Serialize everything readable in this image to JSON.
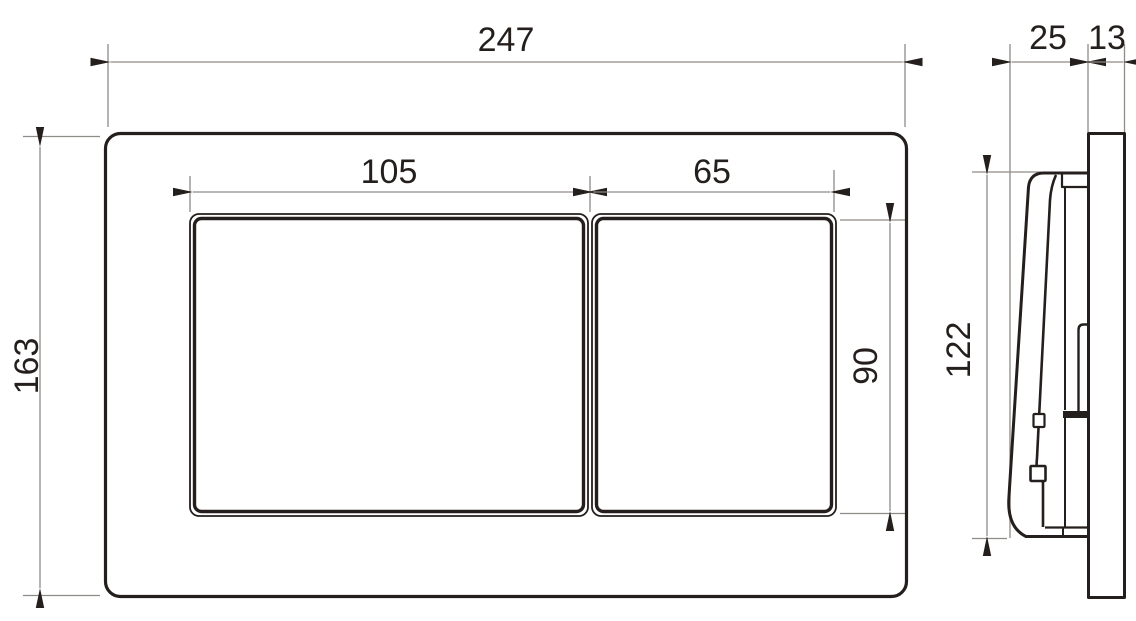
{
  "drawing": {
    "subject": "Two-button flush plate technical dimension drawing, front view and side view",
    "background": "#ffffff"
  },
  "colors": {
    "object_line": "#241f1c",
    "dimension_line": "#8f8b86",
    "label_text": "#241f1c"
  },
  "labels": {
    "overall_width": "247",
    "overall_height": "163",
    "large_button_width": "105",
    "small_button_width": "65",
    "button_height": "90",
    "side_protrusion_depth": "25",
    "side_frame_depth": "13",
    "side_plate_height": "122"
  }
}
